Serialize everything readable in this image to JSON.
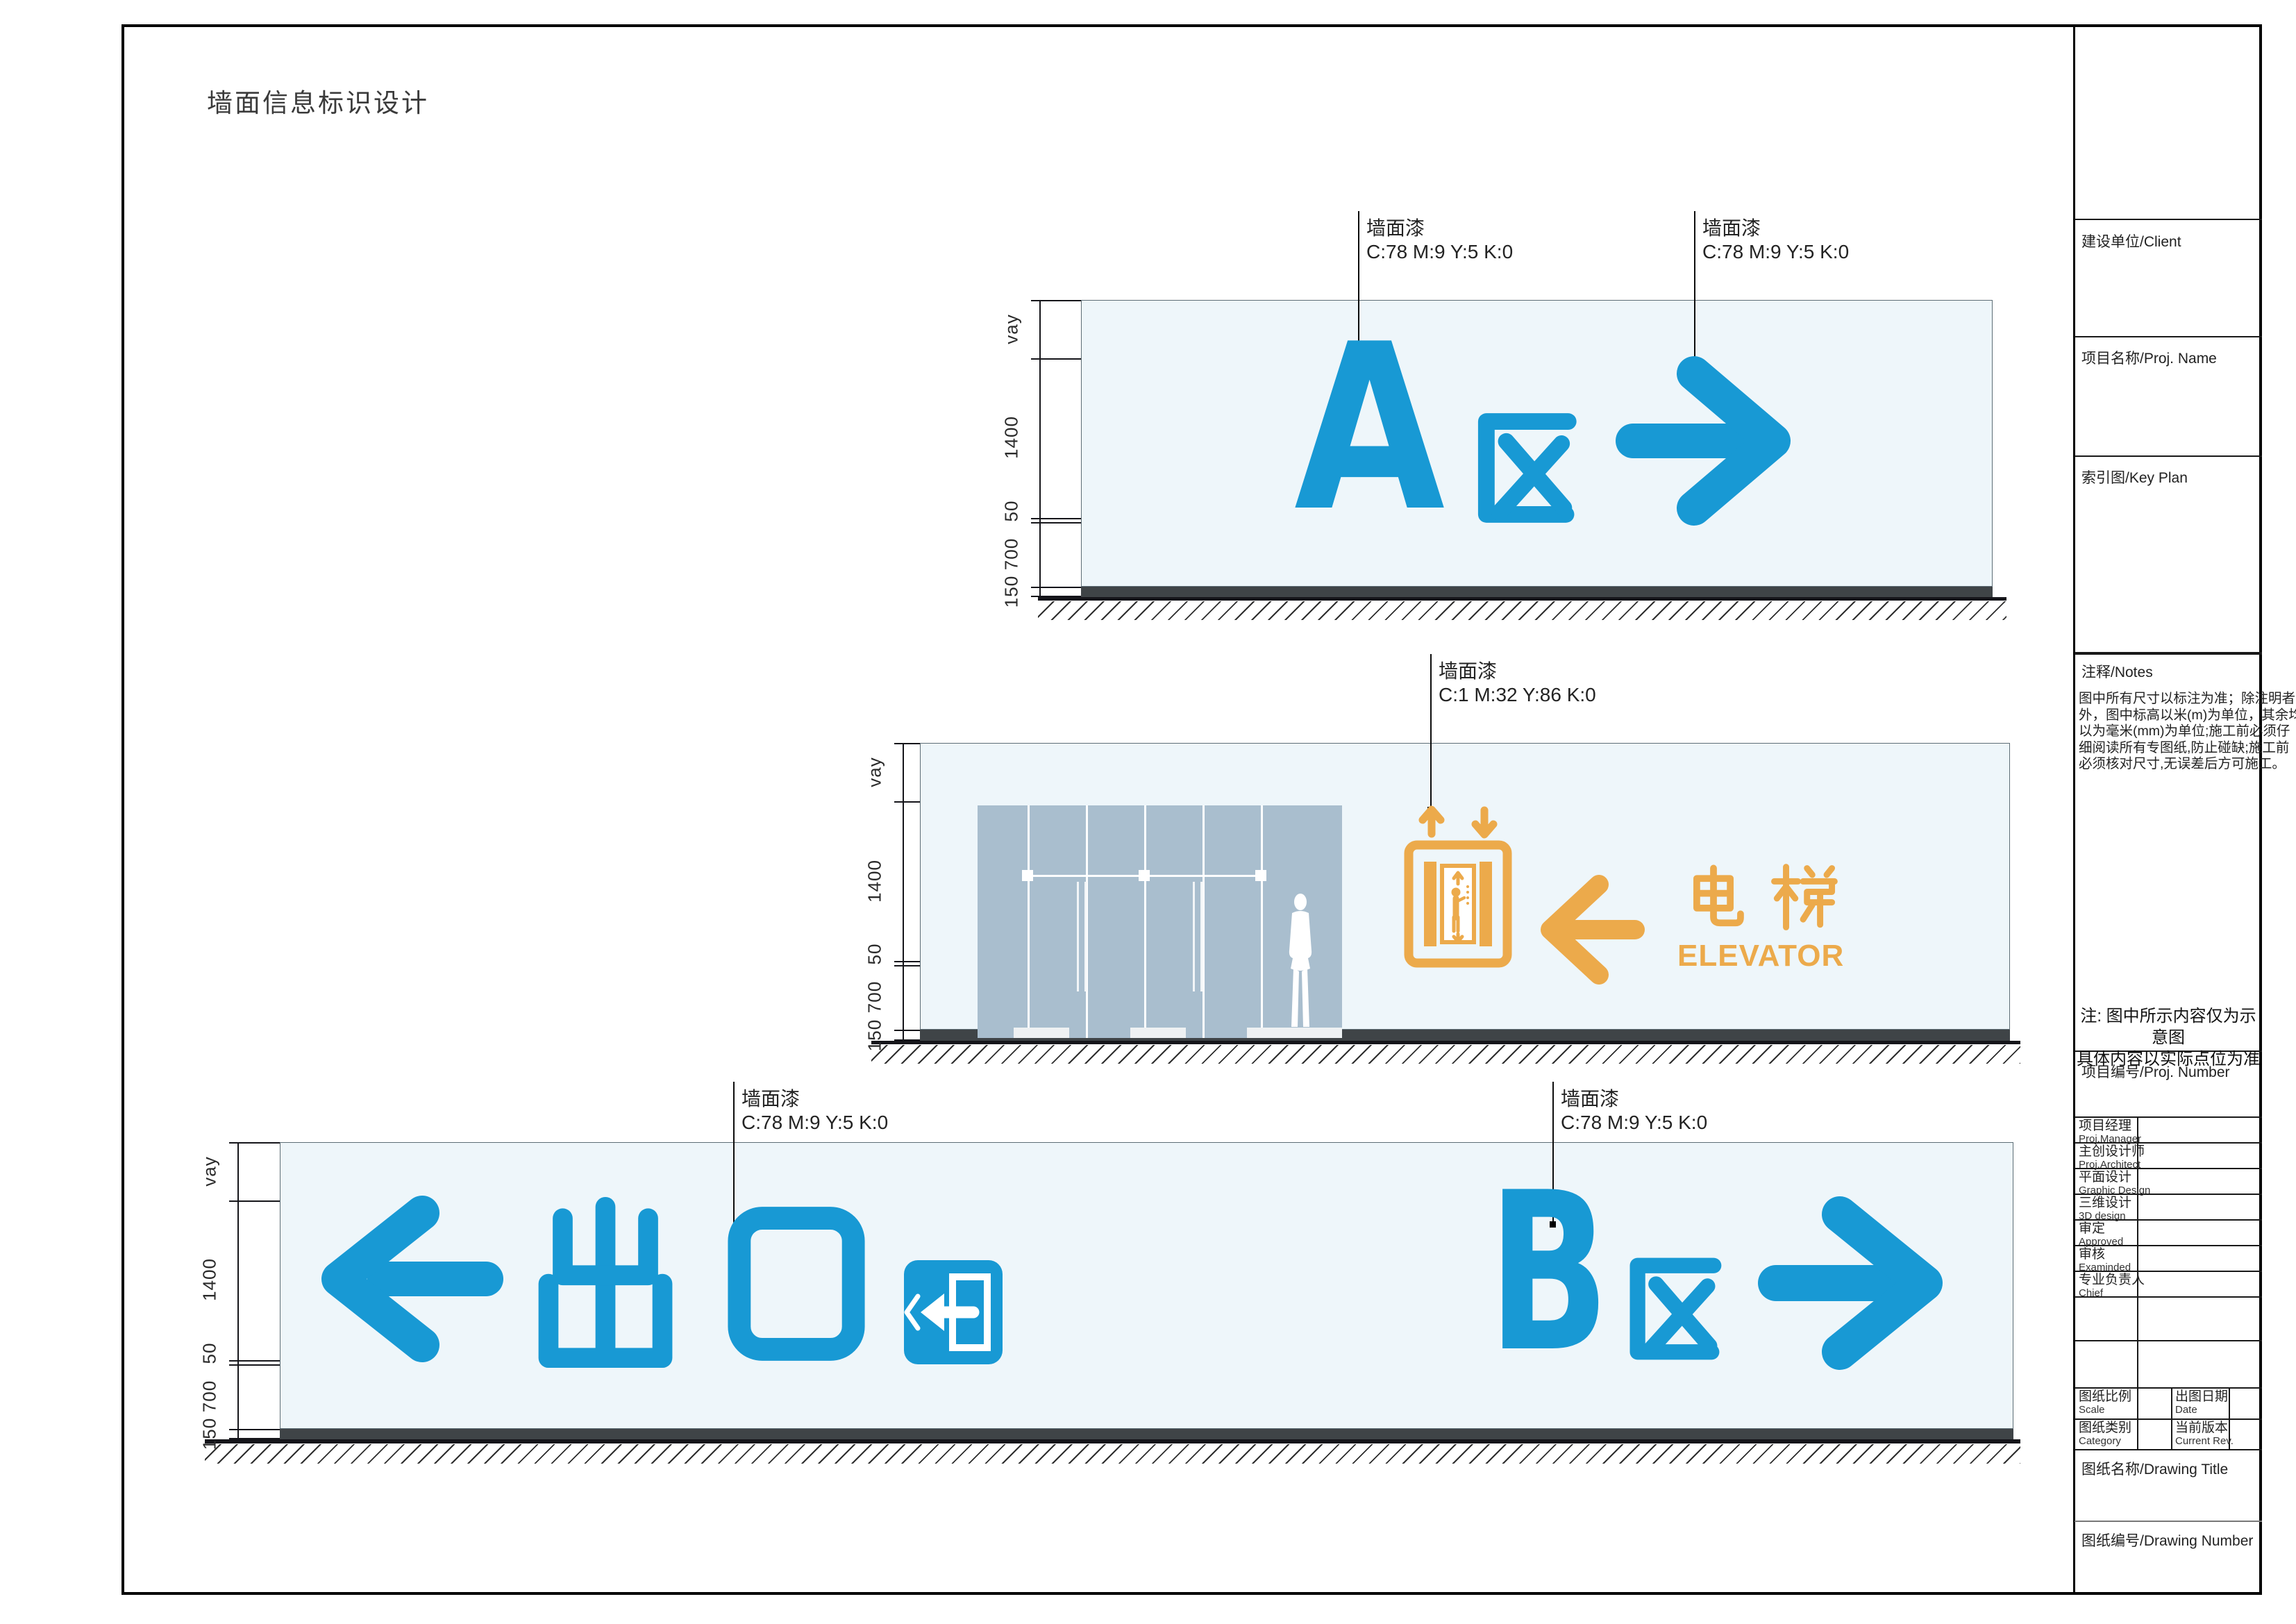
{
  "page": {
    "title": "墙面信息标识设计"
  },
  "colors": {
    "blue": "#1899d4",
    "orange": "#ecaa4b",
    "glass": "#a9bece",
    "wall": "#eef6fa",
    "baseboard": "#3f4447"
  },
  "dims": {
    "labels": [
      "vay",
      "1400",
      "50",
      "700",
      "150"
    ]
  },
  "annotations": {
    "paint_label": "墙面漆",
    "blue_cmyk": "C:78 M:9 Y:5 K:0",
    "orange_cmyk": "C:1 M:32 Y:86 K:0"
  },
  "signs": {
    "zone_a": {
      "letter": "A",
      "suffix": "区",
      "arrow": "right"
    },
    "zone_b": {
      "letter": "B",
      "suffix": "区",
      "arrow": "right"
    },
    "exit": {
      "text": "出口",
      "arrow": "left"
    },
    "elevator": {
      "zh": "电梯",
      "en": "ELEVATOR",
      "arrow": "left"
    }
  },
  "titleblock": {
    "client": "建设单位/Client",
    "proj_name": "项目名称/Proj. Name",
    "key_plan": "索引图/Key Plan",
    "notes_header": "注释/Notes",
    "notes_lines": [
      "图中所有尺寸以标注为准；除注明者",
      "外，图中标高以米(m)为单位，其余均",
      "以为毫米(mm)为单位;施工前必须仔",
      "细阅读所有专图纸,防止碰缺;施工前",
      "必须核对尺寸,无误差后方可施工。"
    ],
    "center_note_line1": "注: 图中所示内容仅为示意图",
    "center_note_line2": "具体内容以实际点位为准",
    "proj_number": "项目编号/Proj. Number",
    "personnel": [
      {
        "zh": "项目经理",
        "en": "Proj.Manager"
      },
      {
        "zh": "主创设计师",
        "en": "Proj.Architect"
      },
      {
        "zh": "平面设计",
        "en": "Graphic Design"
      },
      {
        "zh": "三维设计",
        "en": "3D design"
      },
      {
        "zh": "审定",
        "en": "Approved"
      },
      {
        "zh": "审核",
        "en": "Examinded"
      },
      {
        "zh": "专业负责人",
        "en": "Chief"
      }
    ],
    "scale": {
      "zh": "图纸比例",
      "en": "Scale"
    },
    "date": {
      "zh": "出图日期",
      "en": "Date"
    },
    "category": {
      "zh": "图纸类别",
      "en": "Category"
    },
    "current_rev": {
      "zh": "当前版本",
      "en": "Current Rev."
    },
    "drawing_title": "图纸名称/Drawing Title",
    "drawing_number": "图纸编号/Drawing Number"
  }
}
